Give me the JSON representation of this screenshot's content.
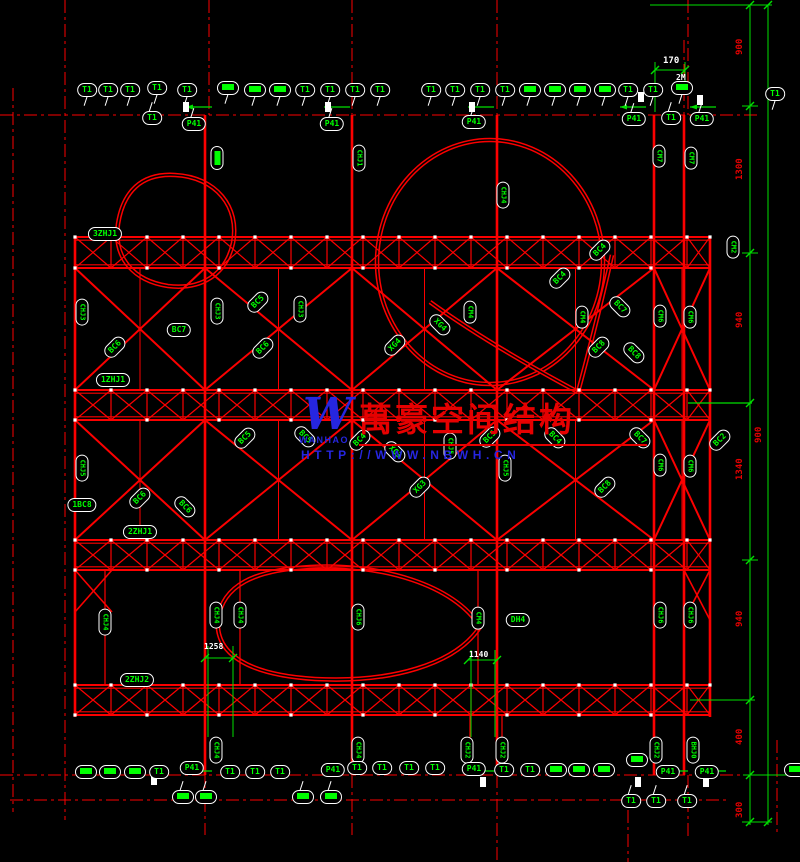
{
  "watermark": {
    "logo_text": "W",
    "logo_subtext": "WANHAO",
    "company": "萬豪空间结构",
    "url": "HTTP://WWW.NBWH.CN"
  },
  "colors": {
    "background": "#000000",
    "line_red": "#fc0000",
    "label_green": "#00ff00",
    "dim_green": "#00e000",
    "white": "#ffffff",
    "watermark_blue": "#2626e0",
    "watermark_red": "#e60000"
  },
  "bubbles": [
    {
      "x": 87,
      "y": 90,
      "o": "h",
      "t": "T1"
    },
    {
      "x": 108,
      "y": 90,
      "o": "h",
      "t": "T1"
    },
    {
      "x": 130,
      "y": 90,
      "o": "h",
      "t": "T1"
    },
    {
      "x": 157,
      "y": 88,
      "o": "h",
      "t": "T1"
    },
    {
      "x": 187,
      "y": 90,
      "o": "h",
      "t": "T1"
    },
    {
      "x": 228,
      "y": 88,
      "o": "h",
      "f": true
    },
    {
      "x": 255,
      "y": 90,
      "o": "h",
      "f": true
    },
    {
      "x": 280,
      "y": 90,
      "o": "h",
      "f": true
    },
    {
      "x": 305,
      "y": 90,
      "o": "h",
      "t": "T1"
    },
    {
      "x": 330,
      "y": 90,
      "o": "h",
      "t": "T1"
    },
    {
      "x": 355,
      "y": 90,
      "o": "h",
      "t": "T1"
    },
    {
      "x": 380,
      "y": 90,
      "o": "h",
      "t": "T1"
    },
    {
      "x": 431,
      "y": 90,
      "o": "h",
      "t": "T1"
    },
    {
      "x": 455,
      "y": 90,
      "o": "h",
      "t": "T1"
    },
    {
      "x": 480,
      "y": 90,
      "o": "h",
      "t": "T1"
    },
    {
      "x": 505,
      "y": 90,
      "o": "h",
      "t": "T1"
    },
    {
      "x": 530,
      "y": 90,
      "o": "h",
      "f": true
    },
    {
      "x": 555,
      "y": 90,
      "o": "h",
      "f": true
    },
    {
      "x": 580,
      "y": 90,
      "o": "h",
      "f": true
    },
    {
      "x": 605,
      "y": 90,
      "o": "h",
      "f": true
    },
    {
      "x": 628,
      "y": 90,
      "o": "h",
      "t": "T1"
    },
    {
      "x": 653,
      "y": 90,
      "o": "h",
      "t": "T1"
    },
    {
      "x": 682,
      "y": 88,
      "o": "h",
      "f": true
    },
    {
      "x": 775,
      "y": 94,
      "o": "h",
      "t": "T1"
    },
    {
      "x": 152,
      "y": 118,
      "o": "h",
      "t": "T1"
    },
    {
      "x": 194,
      "y": 124,
      "o": "h",
      "t": "P41"
    },
    {
      "x": 332,
      "y": 124,
      "o": "h",
      "t": "P41"
    },
    {
      "x": 474,
      "y": 122,
      "o": "h",
      "t": "P41"
    },
    {
      "x": 634,
      "y": 119,
      "o": "h",
      "t": "P41"
    },
    {
      "x": 671,
      "y": 118,
      "o": "h",
      "t": "T1"
    },
    {
      "x": 702,
      "y": 119,
      "o": "h",
      "t": "P41"
    },
    {
      "x": 217,
      "y": 158,
      "o": "v",
      "f": true
    },
    {
      "x": 359,
      "y": 158,
      "o": "v",
      "t": "CHJ1"
    },
    {
      "x": 503,
      "y": 195,
      "o": "v",
      "t": "CHJ4"
    },
    {
      "x": 659,
      "y": 156,
      "o": "v",
      "t": "CM7"
    },
    {
      "x": 691,
      "y": 158,
      "o": "v",
      "t": "CM7"
    },
    {
      "x": 105,
      "y": 234,
      "o": "h",
      "t": "3ZHJ1"
    },
    {
      "x": 82,
      "y": 312,
      "o": "v",
      "t": "CHJ3"
    },
    {
      "x": 217,
      "y": 311,
      "o": "v",
      "t": "CHJ3"
    },
    {
      "x": 300,
      "y": 309,
      "o": "v",
      "t": "CHJ3"
    },
    {
      "x": 470,
      "y": 312,
      "o": "v",
      "t": "CM4"
    },
    {
      "x": 582,
      "y": 317,
      "o": "v",
      "t": "CM4"
    },
    {
      "x": 660,
      "y": 316,
      "o": "v",
      "t": "CM6"
    },
    {
      "x": 690,
      "y": 317,
      "o": "v",
      "t": "CM6"
    },
    {
      "x": 733,
      "y": 247,
      "o": "v",
      "t": "CM2"
    },
    {
      "x": 115,
      "y": 347,
      "o": "d",
      "t": "BC6"
    },
    {
      "x": 258,
      "y": 302,
      "o": "d",
      "t": "BC5"
    },
    {
      "x": 263,
      "y": 348,
      "o": "d",
      "t": "BC6"
    },
    {
      "x": 395,
      "y": 345,
      "o": "d",
      "t": "XG4"
    },
    {
      "x": 440,
      "y": 325,
      "o": "D",
      "t": "XG4"
    },
    {
      "x": 560,
      "y": 278,
      "o": "d",
      "t": "BC4"
    },
    {
      "x": 600,
      "y": 250,
      "o": "d",
      "t": "BC4"
    },
    {
      "x": 599,
      "y": 347,
      "o": "d",
      "t": "BC8"
    },
    {
      "x": 634,
      "y": 353,
      "o": "D",
      "t": "BC8"
    },
    {
      "x": 620,
      "y": 307,
      "o": "D",
      "t": "BC7"
    },
    {
      "x": 179,
      "y": 330,
      "o": "h",
      "t": "BC7"
    },
    {
      "x": 113,
      "y": 380,
      "o": "h",
      "t": "1ZHJ1"
    },
    {
      "x": 82,
      "y": 468,
      "o": "v",
      "t": "CHJ5"
    },
    {
      "x": 450,
      "y": 446,
      "o": "v",
      "t": "CHJ5"
    },
    {
      "x": 505,
      "y": 468,
      "o": "v",
      "t": "CHJ5"
    },
    {
      "x": 660,
      "y": 465,
      "o": "v",
      "t": "CM6"
    },
    {
      "x": 690,
      "y": 466,
      "o": "v",
      "t": "CM6"
    },
    {
      "x": 140,
      "y": 498,
      "o": "d",
      "t": "BC6"
    },
    {
      "x": 185,
      "y": 507,
      "o": "D",
      "t": "BC6"
    },
    {
      "x": 245,
      "y": 438,
      "o": "d",
      "t": "BC5"
    },
    {
      "x": 305,
      "y": 437,
      "o": "D",
      "t": "BC5"
    },
    {
      "x": 360,
      "y": 440,
      "o": "d",
      "t": "BC4"
    },
    {
      "x": 395,
      "y": 452,
      "o": "D",
      "t": "XG3"
    },
    {
      "x": 420,
      "y": 487,
      "o": "d",
      "t": "XG3"
    },
    {
      "x": 490,
      "y": 437,
      "o": "d",
      "t": "BC5"
    },
    {
      "x": 555,
      "y": 438,
      "o": "D",
      "t": "BC4"
    },
    {
      "x": 605,
      "y": 487,
      "o": "d",
      "t": "BC8"
    },
    {
      "x": 640,
      "y": 438,
      "o": "D",
      "t": "BC7"
    },
    {
      "x": 720,
      "y": 440,
      "o": "d",
      "t": "BC2"
    },
    {
      "x": 82,
      "y": 505,
      "o": "h",
      "t": "1BC8"
    },
    {
      "x": 140,
      "y": 532,
      "o": "h",
      "t": "2ZHJ1"
    },
    {
      "x": 105,
      "y": 622,
      "o": "v",
      "t": "CHJ4"
    },
    {
      "x": 216,
      "y": 615,
      "o": "v",
      "t": "CHJ4"
    },
    {
      "x": 240,
      "y": 615,
      "o": "v",
      "t": "CHJ4"
    },
    {
      "x": 358,
      "y": 617,
      "o": "v",
      "t": "CHJ6"
    },
    {
      "x": 478,
      "y": 618,
      "o": "v",
      "t": "CM4"
    },
    {
      "x": 660,
      "y": 615,
      "o": "v",
      "t": "CHJ6"
    },
    {
      "x": 690,
      "y": 615,
      "o": "v",
      "t": "CHJ6"
    },
    {
      "x": 518,
      "y": 620,
      "o": "h",
      "t": "DH4"
    },
    {
      "x": 137,
      "y": 680,
      "o": "h",
      "t": "2ZHJ2"
    },
    {
      "x": 216,
      "y": 750,
      "o": "v",
      "t": "CHJ4"
    },
    {
      "x": 358,
      "y": 750,
      "o": "v",
      "t": "CHJ4"
    },
    {
      "x": 467,
      "y": 750,
      "o": "v",
      "t": "CHJ2"
    },
    {
      "x": 502,
      "y": 750,
      "o": "v",
      "t": "CHJ2"
    },
    {
      "x": 656,
      "y": 750,
      "o": "v",
      "t": "CHJ2"
    },
    {
      "x": 693,
      "y": 750,
      "o": "v",
      "t": "BHJ0"
    },
    {
      "x": 86,
      "y": 772,
      "o": "h",
      "f": true
    },
    {
      "x": 110,
      "y": 772,
      "o": "h",
      "f": true
    },
    {
      "x": 135,
      "y": 772,
      "o": "h",
      "f": true
    },
    {
      "x": 159,
      "y": 772,
      "o": "h",
      "t": "T1"
    },
    {
      "x": 192,
      "y": 768,
      "o": "h",
      "t": "P41"
    },
    {
      "x": 230,
      "y": 772,
      "o": "h",
      "t": "T1"
    },
    {
      "x": 255,
      "y": 772,
      "o": "h",
      "t": "T1"
    },
    {
      "x": 280,
      "y": 772,
      "o": "h",
      "t": "T1"
    },
    {
      "x": 333,
      "y": 770,
      "o": "h",
      "t": "P41"
    },
    {
      "x": 357,
      "y": 768,
      "o": "h",
      "t": "T1"
    },
    {
      "x": 382,
      "y": 768,
      "o": "h",
      "t": "T1"
    },
    {
      "x": 409,
      "y": 768,
      "o": "h",
      "t": "T1"
    },
    {
      "x": 435,
      "y": 768,
      "o": "h",
      "t": "T1"
    },
    {
      "x": 474,
      "y": 769,
      "o": "h",
      "t": "P41"
    },
    {
      "x": 504,
      "y": 770,
      "o": "h",
      "t": "T1"
    },
    {
      "x": 530,
      "y": 770,
      "o": "h",
      "t": "T1"
    },
    {
      "x": 556,
      "y": 770,
      "o": "h",
      "f": true
    },
    {
      "x": 579,
      "y": 770,
      "o": "h",
      "f": true
    },
    {
      "x": 604,
      "y": 770,
      "o": "h",
      "f": true
    },
    {
      "x": 637,
      "y": 760,
      "o": "h",
      "f": true
    },
    {
      "x": 668,
      "y": 772,
      "o": "h",
      "t": "P41"
    },
    {
      "x": 707,
      "y": 772,
      "o": "h",
      "t": "P41"
    },
    {
      "x": 795,
      "y": 770,
      "o": "h",
      "f": true
    },
    {
      "x": 183,
      "y": 797,
      "o": "h",
      "f": true
    },
    {
      "x": 206,
      "y": 797,
      "o": "h",
      "f": true
    },
    {
      "x": 303,
      "y": 797,
      "o": "h",
      "f": true
    },
    {
      "x": 331,
      "y": 797,
      "o": "h",
      "f": true
    },
    {
      "x": 631,
      "y": 801,
      "o": "h",
      "t": "T1"
    },
    {
      "x": 656,
      "y": 801,
      "o": "h",
      "t": "T1"
    },
    {
      "x": 687,
      "y": 801,
      "o": "h",
      "t": "T1"
    }
  ],
  "dims": {
    "right_inner": {
      "x": 742,
      "items": [
        {
          "y": 55,
          "t": "900"
        },
        {
          "y": 180,
          "t": "1300"
        },
        {
          "y": 328,
          "t": "940"
        },
        {
          "y": 480,
          "t": "1340"
        },
        {
          "y": 627,
          "t": "940"
        },
        {
          "y": 745,
          "t": "400"
        },
        {
          "y": 818,
          "t": "300"
        }
      ]
    },
    "right_outer": {
      "x": 761,
      "items": [
        {
          "y": 443,
          "t": "900"
        }
      ]
    },
    "top": {
      "x": 663,
      "y": 63,
      "t": "170"
    },
    "top_note": {
      "x": 676,
      "y": 80,
      "t": "2M"
    },
    "bottom_left": [
      {
        "x": 216,
        "y": 649,
        "t": "1258"
      },
      {
        "x": 481,
        "y": 657,
        "t": "1140"
      }
    ]
  }
}
